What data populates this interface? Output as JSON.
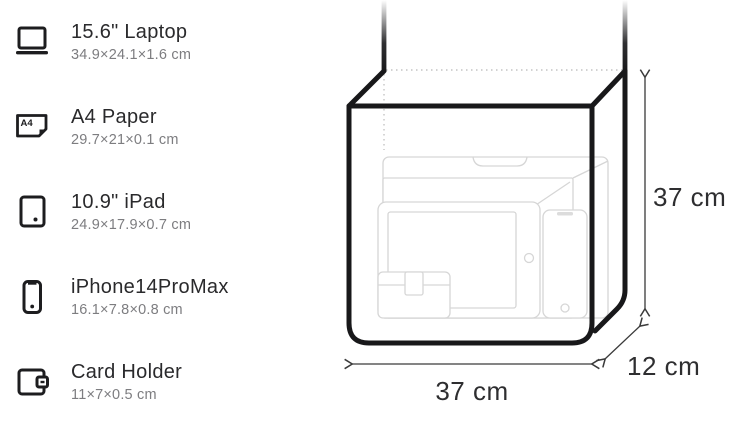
{
  "legend": {
    "items": [
      {
        "label": "15.6\" Laptop",
        "dimensions": "34.9×24.1×1.6 cm",
        "icon": "laptop-icon"
      },
      {
        "label": "A4 Paper",
        "dimensions": "29.7×21×0.1 cm",
        "icon": "a4-paper-icon"
      },
      {
        "label": "10.9\" iPad",
        "dimensions": "24.9×17.9×0.7 cm",
        "icon": "ipad-icon"
      },
      {
        "label": "iPhone14ProMax",
        "dimensions": "16.1×7.8×0.8 cm",
        "icon": "iphone-icon"
      },
      {
        "label": "Card Holder",
        "dimensions": "11×7×0.5 cm",
        "icon": "card-holder-icon"
      }
    ]
  },
  "diagram": {
    "height_label": "37 cm",
    "width_label": "37 cm",
    "depth_label": "12 cm",
    "a4_watermark": "A4",
    "laptop_diagonal_watermark": "15.6",
    "a4_icon_label": "A4"
  },
  "colors": {
    "bag_outline": "#18181a",
    "dimension_text": "#2e2e30",
    "faint_item_outline": "#d6d6d6",
    "muted_text": "#7d7d80"
  }
}
